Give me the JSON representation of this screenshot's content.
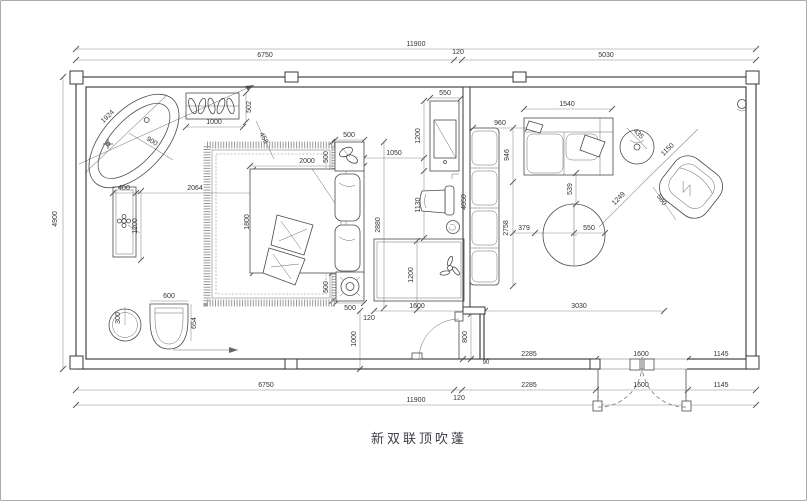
{
  "title": "新双联顶吹蓬",
  "dims": {
    "top_total": "11900",
    "top_left": "6750",
    "top_gap": "120",
    "top_right": "5030",
    "left_height": "4900",
    "a_2285": "2285",
    "a_1600": "1600",
    "a_1145": "1145",
    "b_6750": "6750",
    "b_2285": "2285",
    "b_1600": "1600",
    "b_1145": "1145",
    "c_total": "11900",
    "c_gap": "120",
    "tub_len": "1924",
    "tub_r": "900",
    "box_w": "1000",
    "box_h": "502",
    "van_w": "400",
    "van_gap": "2064",
    "van_h": "1200",
    "basin_r": "300",
    "seat_w": "600",
    "seat_h": "654",
    "bed_w": "2000",
    "bed_h": "1800",
    "diag": "458",
    "ns1_w": "500",
    "ns1_h": "500",
    "ns2_w": "500",
    "ns2_h": "500",
    "gap_1050": "1050",
    "tv_w": "550",
    "tv_h": "1200",
    "chair_h": "1130",
    "side_h": "2880",
    "rug_w": "1600",
    "rug_h": "1200",
    "gap_120": "120",
    "door_off": "1000",
    "door_w": "800",
    "jamb": "90",
    "part_h": "4050",
    "sofa2_w": "960",
    "sofa1_w": "1540",
    "sofa_d": "946",
    "liv_h": "2758",
    "st_d": "435",
    "arm_w": "1150",
    "arm_gap": "1249",
    "arm_d": "580",
    "ct_gap": "539",
    "ct_r": "550",
    "ct_off": "379",
    "liv_w": "3030"
  }
}
